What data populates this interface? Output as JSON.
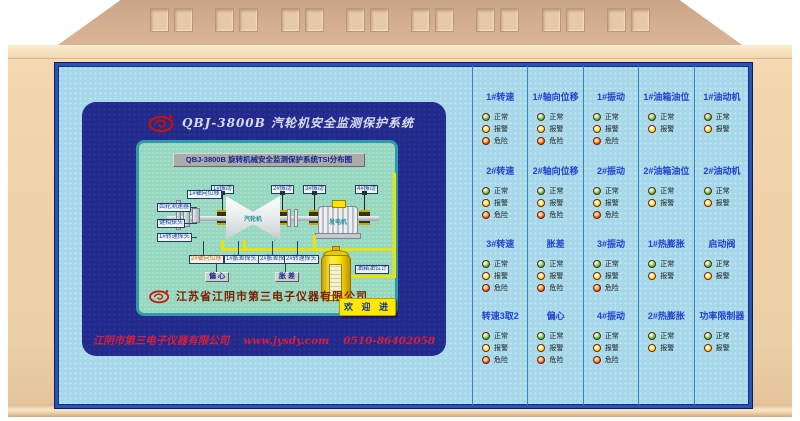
{
  "device": {
    "vent_group_count": 8
  },
  "screen": {
    "header_title": "QBJ-3800B  汽轮机安全监测保护系统",
    "display": {
      "title": "QBJ-3800B 旋转机械安全监测保护系统TSI分布图",
      "diagram": {
        "top_labels": [
          "1#振动",
          "2#振动",
          "3#振动",
          "4#振动"
        ],
        "axial_label": "1#轴向位移",
        "left_labels": [
          "齿轮测速器",
          "键相探头",
          "1#转速探头"
        ],
        "bottom_labels": [
          "2#轴向位移",
          "1#胀差探头",
          "2#胀差探头",
          "2#转速探头"
        ],
        "measure_boxes": [
          "偏 心",
          "胀 差"
        ],
        "turbine_label": "汽轮机",
        "generator_label": "发电机",
        "tank_label": "油箱油位计"
      },
      "company": "江苏省江阴市第三电子仪器有限公司",
      "enter_button": "欢 迎 进 入"
    },
    "footer": {
      "company": "江阴市第三电子仪器有限公司",
      "website": "www.jysdy.com",
      "phone": "0510-86402058"
    }
  },
  "indicator_panel": {
    "led_state_labels": {
      "normal": "正常",
      "alarm": "报警",
      "danger": "危险"
    },
    "led_colors": {
      "normal": "#1ecb1e",
      "alarm": "#ffdf00",
      "danger": "#e5320f"
    },
    "columns": [
      {
        "groups": [
          {
            "label": "1#转速",
            "states": [
              "normal",
              "alarm",
              "danger"
            ]
          },
          {
            "label": "2#转速",
            "states": [
              "normal",
              "alarm",
              "danger"
            ]
          },
          {
            "label": "3#转速",
            "states": [
              "normal",
              "alarm",
              "danger"
            ]
          },
          {
            "label": "转速3取2",
            "states": [
              "normal",
              "alarm",
              "danger"
            ]
          }
        ]
      },
      {
        "groups": [
          {
            "label": "1#轴向位移",
            "states": [
              "normal",
              "alarm",
              "danger"
            ]
          },
          {
            "label": "2#轴向位移",
            "states": [
              "normal",
              "alarm",
              "danger"
            ]
          },
          {
            "label": "胀差",
            "states": [
              "normal",
              "alarm",
              "danger"
            ]
          },
          {
            "label": "偏心",
            "states": [
              "normal",
              "alarm",
              "danger"
            ]
          }
        ]
      },
      {
        "groups": [
          {
            "label": "1#振动",
            "states": [
              "normal",
              "alarm",
              "danger"
            ]
          },
          {
            "label": "2#振动",
            "states": [
              "normal",
              "alarm",
              "danger"
            ]
          },
          {
            "label": "3#振动",
            "states": [
              "normal",
              "alarm",
              "danger"
            ]
          },
          {
            "label": "4#振动",
            "states": [
              "normal",
              "alarm",
              "danger"
            ]
          }
        ]
      },
      {
        "groups": [
          {
            "label": "1#油箱油位",
            "states": [
              "normal",
              "alarm"
            ]
          },
          {
            "label": "2#油箱油位",
            "states": [
              "normal",
              "alarm"
            ]
          },
          {
            "label": "1#热膨胀",
            "states": [
              "normal",
              "alarm"
            ]
          },
          {
            "label": "2#热膨胀",
            "states": [
              "normal",
              "alarm"
            ]
          }
        ]
      },
      {
        "groups": [
          {
            "label": "1#油动机",
            "states": [
              "normal",
              "alarm"
            ]
          },
          {
            "label": "2#油动机",
            "states": [
              "normal",
              "alarm"
            ]
          },
          {
            "label": "启动阀",
            "states": [
              "normal",
              "alarm"
            ]
          },
          {
            "label": "功率限制器",
            "states": [
              "normal",
              "alarm"
            ]
          }
        ]
      }
    ]
  }
}
